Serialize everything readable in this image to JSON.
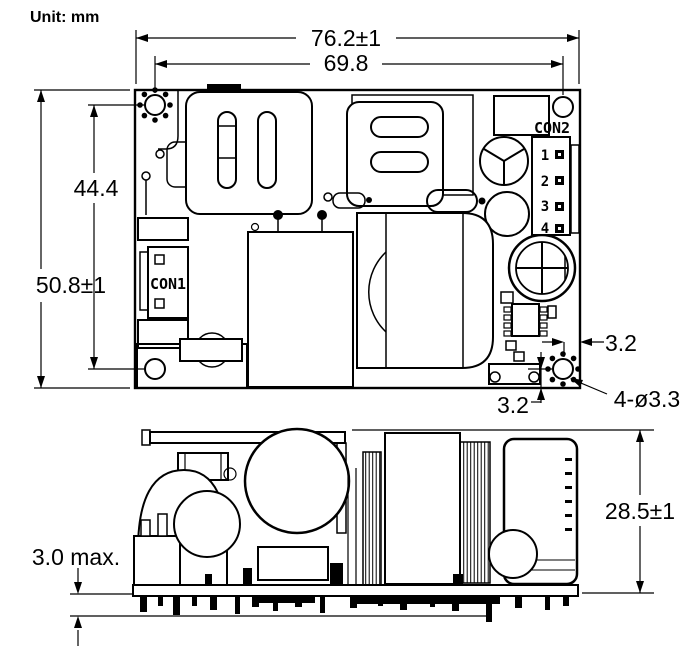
{
  "drawing": {
    "unit_label": "Unit: mm",
    "top_view": {
      "dim_width_overall": "76.2±1",
      "dim_width_hole_to_hole": "69.8",
      "dim_height_hole_to_hole": "44.4",
      "dim_height_overall": "50.8±1",
      "dim_hole_edge_offset_horizontal": "3.2",
      "dim_hole_edge_offset_vertical": "3.2",
      "dim_mounting_holes": "4-ø3.3",
      "con1_label": "CON1",
      "con2_label": "CON2",
      "con2_pin_labels": [
        "1",
        "2",
        "3",
        "4"
      ]
    },
    "side_view": {
      "dim_height_overall": "28.5±1",
      "dim_pin_protrusion": "3.0 max."
    },
    "colors": {
      "line": "#000000",
      "background": "#ffffff"
    }
  }
}
